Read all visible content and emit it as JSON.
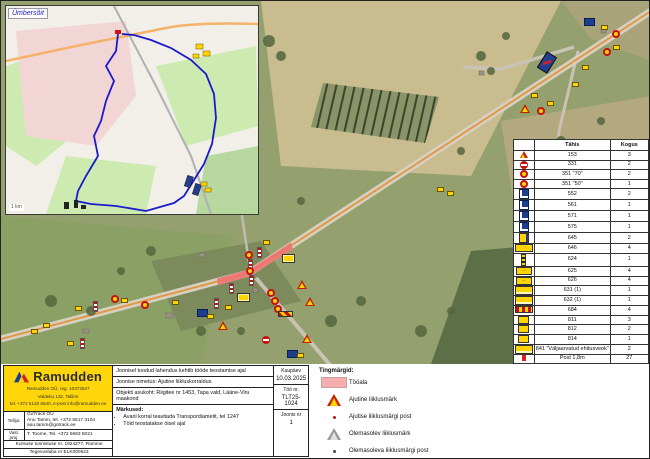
{
  "inset": {
    "label": "Ümbersõit",
    "scale_label": "1 km"
  },
  "legend_table": {
    "headers": {
      "type": "Tähis",
      "qty": "Kogus"
    },
    "rows": [
      {
        "icon": "warning-triangle",
        "code": "153",
        "qty": "3"
      },
      {
        "icon": "no-entry",
        "code": "331",
        "qty": "2"
      },
      {
        "icon": "speed-limit",
        "code": "351 \"70\"",
        "qty": "2"
      },
      {
        "icon": "speed-limit",
        "code": "351 \"50\"",
        "qty": "1"
      },
      {
        "icon": "blue-square",
        "code": "552",
        "qty": "2"
      },
      {
        "icon": "blue-square",
        "code": "561",
        "qty": "1"
      },
      {
        "icon": "blue-square",
        "code": "571",
        "qty": "1"
      },
      {
        "icon": "blue-square",
        "code": "575",
        "qty": "1"
      },
      {
        "icon": "yellow-blue",
        "code": "645",
        "qty": "2"
      },
      {
        "icon": "yellow-wide",
        "code": "646",
        "qty": "4"
      },
      {
        "icon": "post-thin",
        "code": "624",
        "qty": "1"
      },
      {
        "icon": "arrow-right",
        "code": "625",
        "qty": "4"
      },
      {
        "icon": "arrow-left",
        "code": "626",
        "qty": "4"
      },
      {
        "icon": "yellow-text-board",
        "code": "631 (1)",
        "qty": "1"
      },
      {
        "icon": "yellow-text-board",
        "code": "632 (1)",
        "qty": "1"
      },
      {
        "icon": "barrier-striped",
        "code": "684",
        "qty": "4"
      },
      {
        "icon": "yellow-small",
        "code": "811",
        "qty": "3"
      },
      {
        "icon": "yellow-small",
        "code": "812",
        "qty": "2"
      },
      {
        "icon": "yellow-small",
        "code": "814",
        "qty": "1"
      },
      {
        "icon": "yellow-text-board",
        "code": "841 \"Väljaarvatud ehitusveok\"",
        "qty": "2"
      },
      {
        "icon": "post-red",
        "code": "Post 1,8m",
        "qty": "27"
      },
      {
        "icon": "post-magenta",
        "code": "Post 2,3m",
        "qty": "3"
      },
      {
        "icon": "post-blue",
        "code": "Post 3m",
        "qty": "2"
      },
      {
        "icon": "red-lamp",
        "code": "Punane lamp",
        "qty": "4"
      }
    ]
  },
  "symbols_legend": {
    "title": "Tingmärgid:",
    "items": [
      {
        "icon": "work-area-swatch",
        "label": "Tööala"
      },
      {
        "icon": "temp-sign-triangle",
        "label": "Ajutine liiklusmärk"
      },
      {
        "icon": "temp-sign-post-dot",
        "label": "Ajutise liiklusmärgi post"
      },
      {
        "icon": "existing-sign-triangle",
        "label": "Olemasolev liiklusmärk"
      },
      {
        "icon": "existing-sign-post-dot",
        "label": "Olemasoleva liiklusmärgi post"
      }
    ]
  },
  "title_block": {
    "note_top": "Joonisel toodud lahendus kehtib tööde teostamise ajal",
    "drawing_name": "Joonise nimetus: Ajutine liikluskorraldus.",
    "location": "Objekti asukoht: Riigitee nr 1453, Tapa vald, Lääne-Viru maakond",
    "remarks_title": "Märkused:",
    "remarks": [
      "Avarii korral teavitada Transpordiametit, tel 1247",
      "Töid teostatakse öisel ajal"
    ],
    "date_label": "Kuupäev",
    "date": "10.03.2025",
    "work_no_label": "Töö nr.",
    "work_no": "TLT25-1024",
    "sheet_label": "Joonis nr",
    "sheet": "1"
  },
  "company": {
    "logo_text": "Ramudden",
    "address_line1": "Ramudden OÜ, reg. 10372547",
    "address_line2": "Valdeku 132, Tallinn",
    "address_line3": "tel. +372 5130 6540, e-post info@ramudden.ee",
    "client_label": "Tellija:",
    "client_line1": "GoTrack OÜ",
    "client_line2": "Anu Tamm, tel. +372 5617 3104",
    "client_line3": "anu.tamm@gotrack.ee",
    "resp_label": "Vast. proj.",
    "resp_value": "T. Toome, Tel. +372 5663 5021",
    "cert_line": "Kursuse tunnistuse nr. 1924277, Ramme",
    "license_line": "Tegevusluba nr ELK000623"
  },
  "map": {
    "colors": {
      "work_area_pink": "#ee7070",
      "route_blue": "#1a1acd",
      "sign_yellow": "#ffd400",
      "sign_red": "#c41111",
      "sign_blue": "#1d3d8f",
      "ramudden_yellow": "#ffd60a"
    },
    "signs": [
      {
        "t": "blue-board",
        "x": 583,
        "y": 17
      },
      {
        "t": "yellow-board",
        "x": 600,
        "y": 24
      },
      {
        "t": "red-circle-sign",
        "x": 611,
        "y": 29
      },
      {
        "t": "yellow-board",
        "x": 612,
        "y": 44
      },
      {
        "t": "red-circle-sign",
        "x": 602,
        "y": 47
      },
      {
        "t": "blue-board-large",
        "x": 540,
        "y": 52,
        "rot": 32
      },
      {
        "t": "yellow-board",
        "x": 581,
        "y": 64
      },
      {
        "t": "yellow-board",
        "x": 571,
        "y": 81
      },
      {
        "t": "warning-triangle",
        "x": 519,
        "y": 84
      },
      {
        "t": "yellow-board",
        "x": 530,
        "y": 92
      },
      {
        "t": "yellow-board",
        "x": 546,
        "y": 100
      },
      {
        "t": "red-circle-sign",
        "x": 536,
        "y": 106
      },
      {
        "t": "yellow-board",
        "x": 436,
        "y": 186
      },
      {
        "t": "yellow-board",
        "x": 446,
        "y": 190
      },
      {
        "t": "red-circle-sign",
        "x": 244,
        "y": 250
      },
      {
        "t": "striped-post",
        "x": 247,
        "y": 258
      },
      {
        "t": "red-circle-sign",
        "x": 245,
        "y": 266
      },
      {
        "t": "striped-post",
        "x": 248,
        "y": 274
      },
      {
        "t": "yellow-board-large",
        "x": 281,
        "y": 253
      },
      {
        "t": "warning-triangle",
        "x": 296,
        "y": 251
      },
      {
        "t": "warning-triangle",
        "x": 304,
        "y": 259
      },
      {
        "t": "warning-triangle",
        "x": 217,
        "y": 274
      },
      {
        "t": "striped-post",
        "x": 228,
        "y": 282
      },
      {
        "t": "yellow-board-large",
        "x": 236,
        "y": 292
      },
      {
        "t": "yellow-board",
        "x": 224,
        "y": 304
      },
      {
        "t": "red-circle-sign",
        "x": 266,
        "y": 288
      },
      {
        "t": "red-circle-sign",
        "x": 270,
        "y": 296
      },
      {
        "t": "red-circle-sign",
        "x": 273,
        "y": 304
      },
      {
        "t": "striped-barrier",
        "x": 277,
        "y": 310
      },
      {
        "t": "warning-triangle",
        "x": 301,
        "y": 278
      },
      {
        "t": "no-entry-sign",
        "x": 261,
        "y": 271
      },
      {
        "t": "striped-post",
        "x": 256,
        "y": 246
      },
      {
        "t": "yellow-board",
        "x": 262,
        "y": 239
      },
      {
        "t": "blue-board",
        "x": 196,
        "y": 308
      },
      {
        "t": "yellow-board",
        "x": 206,
        "y": 313
      },
      {
        "t": "striped-post",
        "x": 213,
        "y": 297
      },
      {
        "t": "blue-board-large",
        "x": 14,
        "y": 322,
        "rot": 0
      },
      {
        "t": "yellow-board",
        "x": 30,
        "y": 328
      },
      {
        "t": "yellow-board",
        "x": 42,
        "y": 322
      },
      {
        "t": "warning-triangle",
        "x": 61,
        "y": 299
      },
      {
        "t": "yellow-board",
        "x": 74,
        "y": 305
      },
      {
        "t": "striped-post",
        "x": 92,
        "y": 300
      },
      {
        "t": "red-circle-sign",
        "x": 110,
        "y": 294
      },
      {
        "t": "yellow-board",
        "x": 120,
        "y": 297
      },
      {
        "t": "yellow-board",
        "x": 66,
        "y": 340
      },
      {
        "t": "striped-post",
        "x": 79,
        "y": 337
      },
      {
        "t": "warning-triangle",
        "x": 158,
        "y": 294
      },
      {
        "t": "yellow-board",
        "x": 171,
        "y": 299
      },
      {
        "t": "red-circle-sign",
        "x": 140,
        "y": 300
      },
      {
        "t": "blue-board",
        "x": 286,
        "y": 349
      },
      {
        "t": "yellow-board",
        "x": 296,
        "y": 352
      }
    ]
  }
}
